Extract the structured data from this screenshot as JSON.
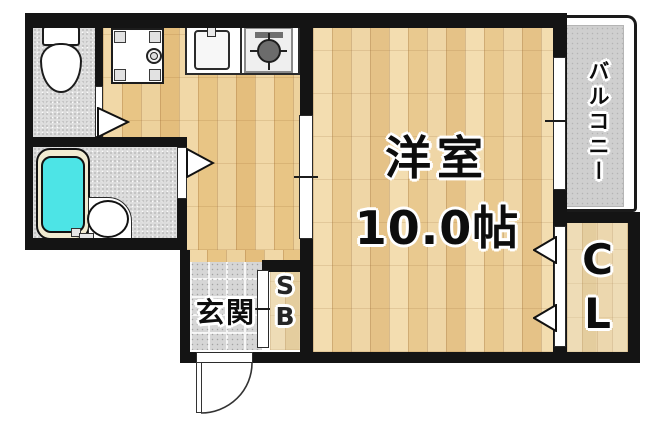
{
  "plan": {
    "type": "apartment-floor-plan",
    "rooms": {
      "main": {
        "name_line1": "洋室",
        "name_line2": "10.0帖"
      },
      "balcony": {
        "label": "バルコニー"
      },
      "closet": {
        "line1": "C",
        "line2": "L"
      },
      "shoebox": {
        "line1": "S",
        "line2": "B"
      },
      "entrance": {
        "label": "玄関"
      }
    },
    "fixtures": [
      "toilet",
      "washing-machine-pan",
      "kitchen-sink",
      "gas-stove",
      "bathtub",
      "washbasin",
      "entrance-door-swing",
      "window",
      "sliding-door",
      "door-arrows"
    ],
    "colors": {
      "wall": "#141414",
      "wood": "#eed2a0",
      "wood_pale": "#e9d6ae",
      "tile": "#d6d6d6",
      "speckle": "#dcdcdc",
      "balcony_floor": "#cfcfcf",
      "tub_water": "#4de4e6",
      "tub_rim": "#f1ebd1"
    }
  }
}
